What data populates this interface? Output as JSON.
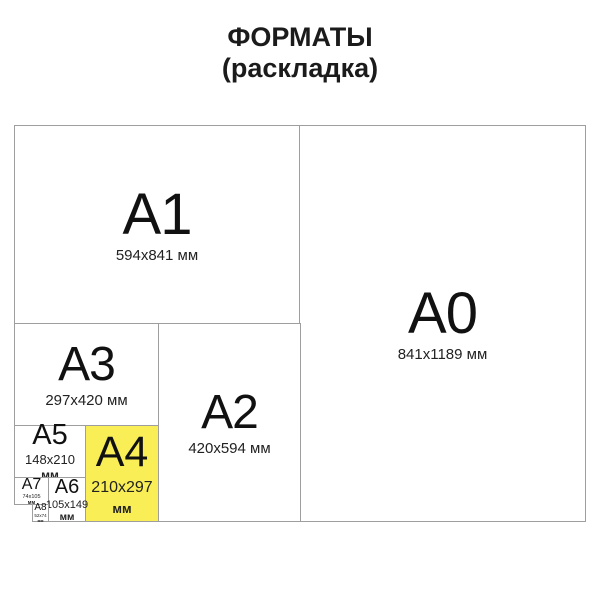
{
  "title": {
    "line1": "ФОРМАТЫ",
    "line2": "(раскладка)"
  },
  "colors": {
    "highlight": "#F9EE55",
    "border": "#9e9e9e",
    "text": "#151515"
  },
  "formats": {
    "a0": {
      "label": "A0",
      "dims": "841x1189 мм"
    },
    "a1": {
      "label": "A1",
      "dims": "594x841 мм"
    },
    "a2": {
      "label": "A2",
      "dims": "420x594 мм"
    },
    "a3": {
      "label": "A3",
      "dims": "297x420 мм"
    },
    "a4": {
      "label": "A4",
      "dims_line1": "210x297",
      "dims_line2": "мм"
    },
    "a5": {
      "label": "A5",
      "dims_line1": "148x210",
      "dims_line2": "мм"
    },
    "a6": {
      "label": "A6",
      "dims_line1": "105x149",
      "dims_line2": "мм"
    },
    "a7": {
      "label": "A7",
      "dims_line1": "74x105",
      "dims_line2": "мм"
    },
    "a8": {
      "label": "A8",
      "dims_line1": "52x74",
      "dims_line2": "мм"
    }
  }
}
